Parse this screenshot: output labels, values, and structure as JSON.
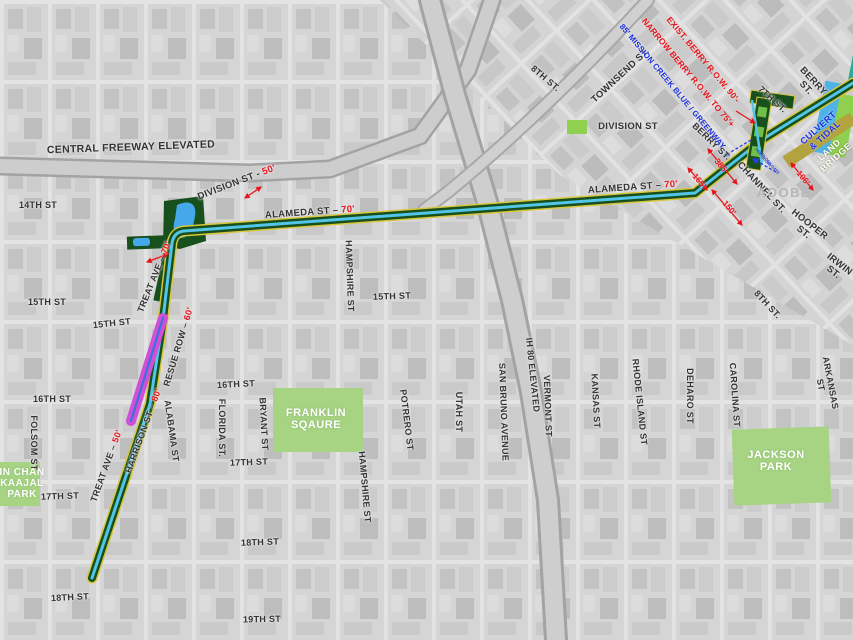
{
  "map": {
    "description_labels_note": "static planning map of Mission Creek greenway corridor, San Francisco",
    "colors": {
      "corridor_yellow": "#d9c63f",
      "corridor_green": "#17501d",
      "corridor_cyan": "#52c5e8",
      "magenta_segment": "#cf4fd9",
      "magenta_center_blue": "#3f6fd9",
      "park_green": "#a6d483",
      "bright_green": "#8fd14f",
      "water_blue": "#4fb3e8",
      "land_bridge_olive": "#b3a33f",
      "annotation_red": "#e8131b",
      "annotation_blue": "#1b2fe0",
      "basemap_gray": "#d2d2d2"
    },
    "parks": [
      {
        "name": "FRANKLIN SQAURE"
      },
      {
        "name": "JACKSON PARK"
      },
      {
        "name": "IN CHAN KAAJAL PARK"
      }
    ],
    "route_segments": [
      {
        "name": "greenway corridor (yellow/green/cyan stripes)"
      },
      {
        "name": "magenta segment on Treat Ave between 15th and 16th"
      },
      {
        "name": "culvert & tidal section"
      },
      {
        "name": "land bridge band"
      },
      {
        "name": "7th St plaza strip"
      }
    ],
    "labels": [
      {
        "n": "street-label-central-freeway-elevated",
        "t": "CENTRAL FREEWAY ELEVATED",
        "x": 131,
        "y": 148,
        "r": -2,
        "s": 10.5,
        "c": "street"
      },
      {
        "n": "street-label-14th-st",
        "t": "14TH ST",
        "x": 38,
        "y": 206,
        "r": 0,
        "s": 9,
        "c": "street"
      },
      {
        "n": "street-label-division-st-50",
        "t": "DIVISION ST - ",
        "d": "50'",
        "x": 237,
        "y": 183,
        "r": -21,
        "s": 9.5,
        "c": "street"
      },
      {
        "n": "street-label-alameda-st-70-west",
        "t": "ALAMEDA ST – ",
        "d": "70'",
        "x": 310,
        "y": 213,
        "r": -4,
        "s": 9.5,
        "c": "street"
      },
      {
        "n": "street-label-alameda-st-70-east",
        "t": "ALAMEDA ST – ",
        "d": "70'",
        "x": 633,
        "y": 188,
        "r": -4,
        "s": 9.5,
        "c": "street"
      },
      {
        "n": "street-label-treat-ave-70",
        "t": "TREAT AVE – ",
        "d": "70'",
        "x": 155,
        "y": 277,
        "r": -68,
        "s": 9,
        "c": "street"
      },
      {
        "n": "street-label-resue-row-60",
        "t": "RESUE ROW – ",
        "d": "60'",
        "x": 179,
        "y": 347,
        "r": -73,
        "s": 9,
        "c": "street"
      },
      {
        "n": "street-label-treat-ave-50",
        "t": "TREAT AVE – ",
        "d": "50'",
        "x": 107,
        "y": 466,
        "r": -70,
        "s": 9,
        "c": "street"
      },
      {
        "n": "street-label-harrison-st-80",
        "t": "HARRISON ST – ",
        "d": "80'",
        "x": 144,
        "y": 431,
        "r": -70,
        "s": 9,
        "c": "street"
      },
      {
        "n": "street-label-15th-st-a",
        "t": "15TH ST",
        "x": 47,
        "y": 303,
        "r": 0,
        "s": 9,
        "c": "street"
      },
      {
        "n": "street-label-15th-st-b",
        "t": "15TH ST",
        "x": 112,
        "y": 324,
        "r": -6,
        "s": 9,
        "c": "street"
      },
      {
        "n": "street-label-15th-st-c",
        "t": "15TH ST",
        "x": 392,
        "y": 297,
        "r": -2,
        "s": 9,
        "c": "street"
      },
      {
        "n": "street-label-16th-st-a",
        "t": "16TH ST",
        "x": 52,
        "y": 400,
        "r": 0,
        "s": 9,
        "c": "street"
      },
      {
        "n": "street-label-16th-st-b",
        "t": "16TH ST",
        "x": 236,
        "y": 385,
        "r": -3,
        "s": 9,
        "c": "street"
      },
      {
        "n": "street-label-17th-st-a",
        "t": "17TH ST",
        "x": 60,
        "y": 497,
        "r": -2,
        "s": 9,
        "c": "street"
      },
      {
        "n": "street-label-17th-st-b",
        "t": "17TH ST",
        "x": 249,
        "y": 463,
        "r": -2,
        "s": 9,
        "c": "street"
      },
      {
        "n": "street-label-18th-st-a",
        "t": "18TH ST",
        "x": 70,
        "y": 598,
        "r": -3,
        "s": 9,
        "c": "street"
      },
      {
        "n": "street-label-18th-st-b",
        "t": "18TH ST",
        "x": 260,
        "y": 543,
        "r": -2,
        "s": 9,
        "c": "street"
      },
      {
        "n": "street-label-19th-st",
        "t": "19TH ST",
        "x": 262,
        "y": 620,
        "r": -1,
        "s": 9,
        "c": "street"
      },
      {
        "n": "street-label-folsom-st",
        "t": "FOLSOM ST",
        "x": 33,
        "y": 443,
        "r": 90,
        "s": 9,
        "c": "street"
      },
      {
        "n": "street-label-alabama-st",
        "t": "ALABAMA ST",
        "x": 171,
        "y": 431,
        "r": 82,
        "s": 9,
        "c": "street"
      },
      {
        "n": "street-label-florida-st",
        "t": "FLORIDA ST.",
        "x": 221,
        "y": 428,
        "r": 90,
        "s": 9,
        "c": "street"
      },
      {
        "n": "street-label-bryant-st",
        "t": "BRYANT ST",
        "x": 263,
        "y": 424,
        "r": 87,
        "s": 9,
        "c": "street"
      },
      {
        "n": "street-label-hampshire-st-north",
        "t": "HAMPSHIRE ST",
        "x": 349,
        "y": 276,
        "r": 88,
        "s": 9,
        "c": "street"
      },
      {
        "n": "street-label-hampshire-st-south",
        "t": "HAMPSHIRE ST",
        "x": 364,
        "y": 487,
        "r": 85,
        "s": 9,
        "c": "street"
      },
      {
        "n": "street-label-potrero-st",
        "t": "POTRERO ST",
        "x": 406,
        "y": 420,
        "r": 83,
        "s": 9,
        "c": "street"
      },
      {
        "n": "street-label-utah-st",
        "t": "UTAH ST",
        "x": 458,
        "y": 412,
        "r": 90,
        "s": 9,
        "c": "street"
      },
      {
        "n": "street-label-san-bruno-avenue",
        "t": "SAN BRUNO AVENUE",
        "x": 503,
        "y": 412,
        "r": 88,
        "s": 9,
        "c": "street"
      },
      {
        "n": "street-label-ih-80-elevated",
        "t": "IH 80 ELEVATED",
        "x": 532,
        "y": 375,
        "r": 84,
        "s": 9,
        "c": "street"
      },
      {
        "n": "street-label-vermont-st",
        "t": "VERMONT ST",
        "x": 547,
        "y": 406,
        "r": 88,
        "s": 9,
        "c": "street"
      },
      {
        "n": "street-label-kansas-st",
        "t": "KANSAS ST",
        "x": 595,
        "y": 401,
        "r": 87,
        "s": 9,
        "c": "street"
      },
      {
        "n": "street-label-rhode-island-st",
        "t": "RHODE ISLAND ST",
        "x": 639,
        "y": 402,
        "r": 84,
        "s": 9,
        "c": "street"
      },
      {
        "n": "street-label-deharo-st",
        "t": "DEHARO ST",
        "x": 689,
        "y": 396,
        "r": 90,
        "s": 9,
        "c": "street"
      },
      {
        "n": "street-label-carolina-st",
        "t": "CAROLINA ST",
        "x": 734,
        "y": 395,
        "r": 86,
        "s": 9,
        "c": "street"
      },
      {
        "n": "street-label-arkansas-st",
        "t": "ARKANSAS ST",
        "x": 825,
        "y": 384,
        "r": 79,
        "s": 9,
        "c": "street"
      },
      {
        "n": "street-label-townsend-st",
        "t": "TOWNSEND ST.",
        "x": 621,
        "y": 76,
        "r": -43,
        "s": 9.5,
        "c": "street"
      },
      {
        "n": "street-label-8th-st-top",
        "t": "8TH ST.",
        "x": 545,
        "y": 79,
        "r": 40,
        "s": 9,
        "c": "street"
      },
      {
        "n": "street-label-division-st-east",
        "t": "DIVISION ST",
        "x": 628,
        "y": 127,
        "r": 0,
        "s": 9.5,
        "c": "street"
      },
      {
        "n": "street-label-7th-st",
        "t": "7TH ST.",
        "x": 772,
        "y": 100,
        "r": 42,
        "s": 9,
        "c": "street"
      },
      {
        "n": "street-label-berry-st-ne",
        "t": "BERRY ST.",
        "x": 809,
        "y": 85,
        "r": 47,
        "s": 9.5,
        "c": "street"
      },
      {
        "n": "street-label-berry-st-w",
        "t": "BERRY ST.",
        "x": 711,
        "y": 142,
        "r": 44,
        "s": 9,
        "c": "street"
      },
      {
        "n": "street-label-channel-st",
        "t": "CHANNEL ST.",
        "x": 761,
        "y": 188,
        "r": 47,
        "s": 9.5,
        "c": "street"
      },
      {
        "n": "street-label-hooper-st",
        "t": "HOOPER ST.",
        "x": 806,
        "y": 229,
        "r": 38,
        "s": 9.5,
        "c": "street"
      },
      {
        "n": "street-label-irwin-st",
        "t": "IRWIN ST.",
        "x": 836,
        "y": 269,
        "r": 38,
        "s": 9.5,
        "c": "street"
      },
      {
        "n": "street-label-8th-st-right",
        "t": "8TH ST.",
        "x": 767,
        "y": 305,
        "r": 47,
        "s": 9,
        "c": "street"
      },
      {
        "n": "franklin-square-label",
        "t": "FRANKLIN\nSQAURE",
        "x": 316,
        "y": 420,
        "r": 0,
        "s": 11,
        "c": "park-label"
      },
      {
        "n": "jackson-park-label",
        "t": "JACKSON\nPARK",
        "x": 776,
        "y": 462,
        "r": 0,
        "s": 11,
        "c": "park-label"
      },
      {
        "n": "in-chan-kaajal-park-label",
        "t": "IN CHAN\nKAAJAL\nPARK",
        "x": 22,
        "y": 484,
        "r": 0,
        "s": 10,
        "c": "park-label"
      },
      {
        "n": "basemap-label-adobe",
        "t": "ADOBE",
        "x": 784,
        "y": 193,
        "r": 0,
        "s": 13,
        "c": "bg-label"
      },
      {
        "n": "annotation-exist-berry-row",
        "t": "EXIST. BERRY R.O.W. 90'-",
        "x": 703,
        "y": 60,
        "r": 50,
        "s": 8.5,
        "c": "red-annot"
      },
      {
        "n": "annotation-narrow-berry-row",
        "t": "NARROW BERRY R.O.W. TO 75'+",
        "x": 688,
        "y": 73,
        "r": 50,
        "s": 8.5,
        "c": "red-annot"
      },
      {
        "n": "annotation-mission-creek-blue-greenway",
        "t": "85' MISSION CREEK BLUE / GREENWAY",
        "x": 672,
        "y": 87,
        "r": 50,
        "s": 8,
        "c": "blue-annot"
      },
      {
        "n": "annotation-culvert-tidal",
        "t": "CULVERT & TIDAL",
        "x": 822,
        "y": 132,
        "r": -42,
        "s": 9,
        "c": "culvert-label"
      },
      {
        "n": "annotation-land-bridge",
        "t": "LAND BRIDGE",
        "x": 833,
        "y": 154,
        "r": -42,
        "s": 9,
        "c": "bridge-label"
      },
      {
        "n": "dimension-165",
        "t": "165'",
        "x": 699,
        "y": 181,
        "r": 50,
        "s": 8.5,
        "c": "dim-label"
      },
      {
        "n": "dimension-385",
        "t": "385'",
        "x": 721,
        "y": 166,
        "r": 50,
        "s": 8.5,
        "c": "dim-label"
      },
      {
        "n": "dimension-150",
        "t": "150'",
        "x": 729,
        "y": 208,
        "r": 50,
        "s": 8.5,
        "c": "dim-label"
      },
      {
        "n": "dimension-106",
        "t": "106'",
        "x": 803,
        "y": 178,
        "r": 50,
        "s": 8.5,
        "c": "dim-label"
      },
      {
        "n": "micro-annotation-1",
        "t": "PED GLORY",
        "x": 763,
        "y": 158,
        "r": 50,
        "s": 4,
        "c": "micro"
      },
      {
        "n": "micro-annotation-2",
        "t": "GOLDEN GATE",
        "x": 769,
        "y": 163,
        "r": 50,
        "s": 4,
        "c": "micro"
      }
    ]
  }
}
